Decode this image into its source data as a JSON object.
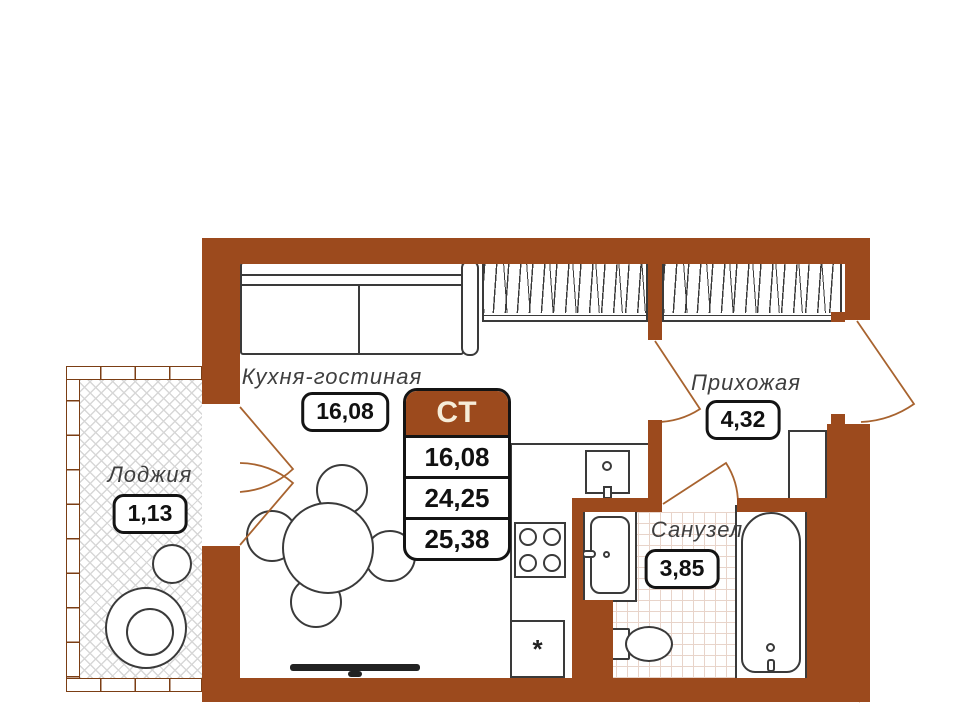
{
  "plan": {
    "stat_card": {
      "type_label": "СТ",
      "values": [
        "16,08",
        "24,25",
        "25,38"
      ]
    },
    "rooms": {
      "kitchen_living": {
        "label": "Кухня-гостиная",
        "area": "16,08"
      },
      "hallway": {
        "label": "Прихожая",
        "area": "4,32"
      },
      "loggia": {
        "label": "Лоджия",
        "area": "1,13"
      },
      "bathroom": {
        "label": "Санузел",
        "area": "3,85"
      }
    },
    "symbols": {
      "fridge": "*"
    },
    "colors": {
      "wall": "#9c4a1d",
      "door_swing": "#a8632f",
      "outline": "#3a3a3a",
      "card_header_bg": "#9c4a1d",
      "card_header_text": "#f6ecd8",
      "tile_line": "#e8d4ca",
      "loggia_hatch": "#d7d7d7"
    }
  }
}
